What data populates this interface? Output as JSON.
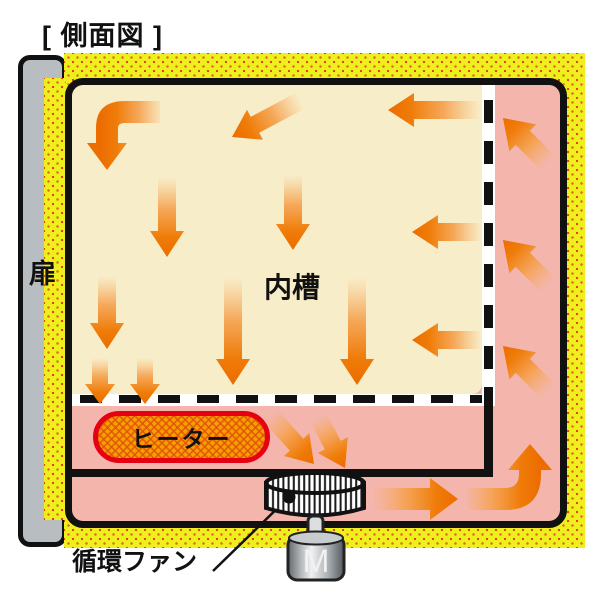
{
  "title": "[ 側面図 ]",
  "diagram": {
    "door": {
      "label": "扉"
    },
    "inner_chamber": {
      "label": "内槽"
    },
    "heater": {
      "label": "ヒーター"
    },
    "circulation_fan": {
      "label": "循環ファン"
    },
    "motor": {
      "label": "M"
    },
    "airflow": {
      "arrow_count": 19,
      "arrow_color": "#EC6C00"
    },
    "colors": {
      "insulation": "#F0EF1E",
      "insulation_dots": "#D9691F",
      "duct": "#F4B5AC",
      "chamber": "#F8EDC9",
      "heater_fill": "#F6A000",
      "heater_border": "#E60012",
      "door": "#B7BDC1",
      "outline": "#111111"
    }
  }
}
